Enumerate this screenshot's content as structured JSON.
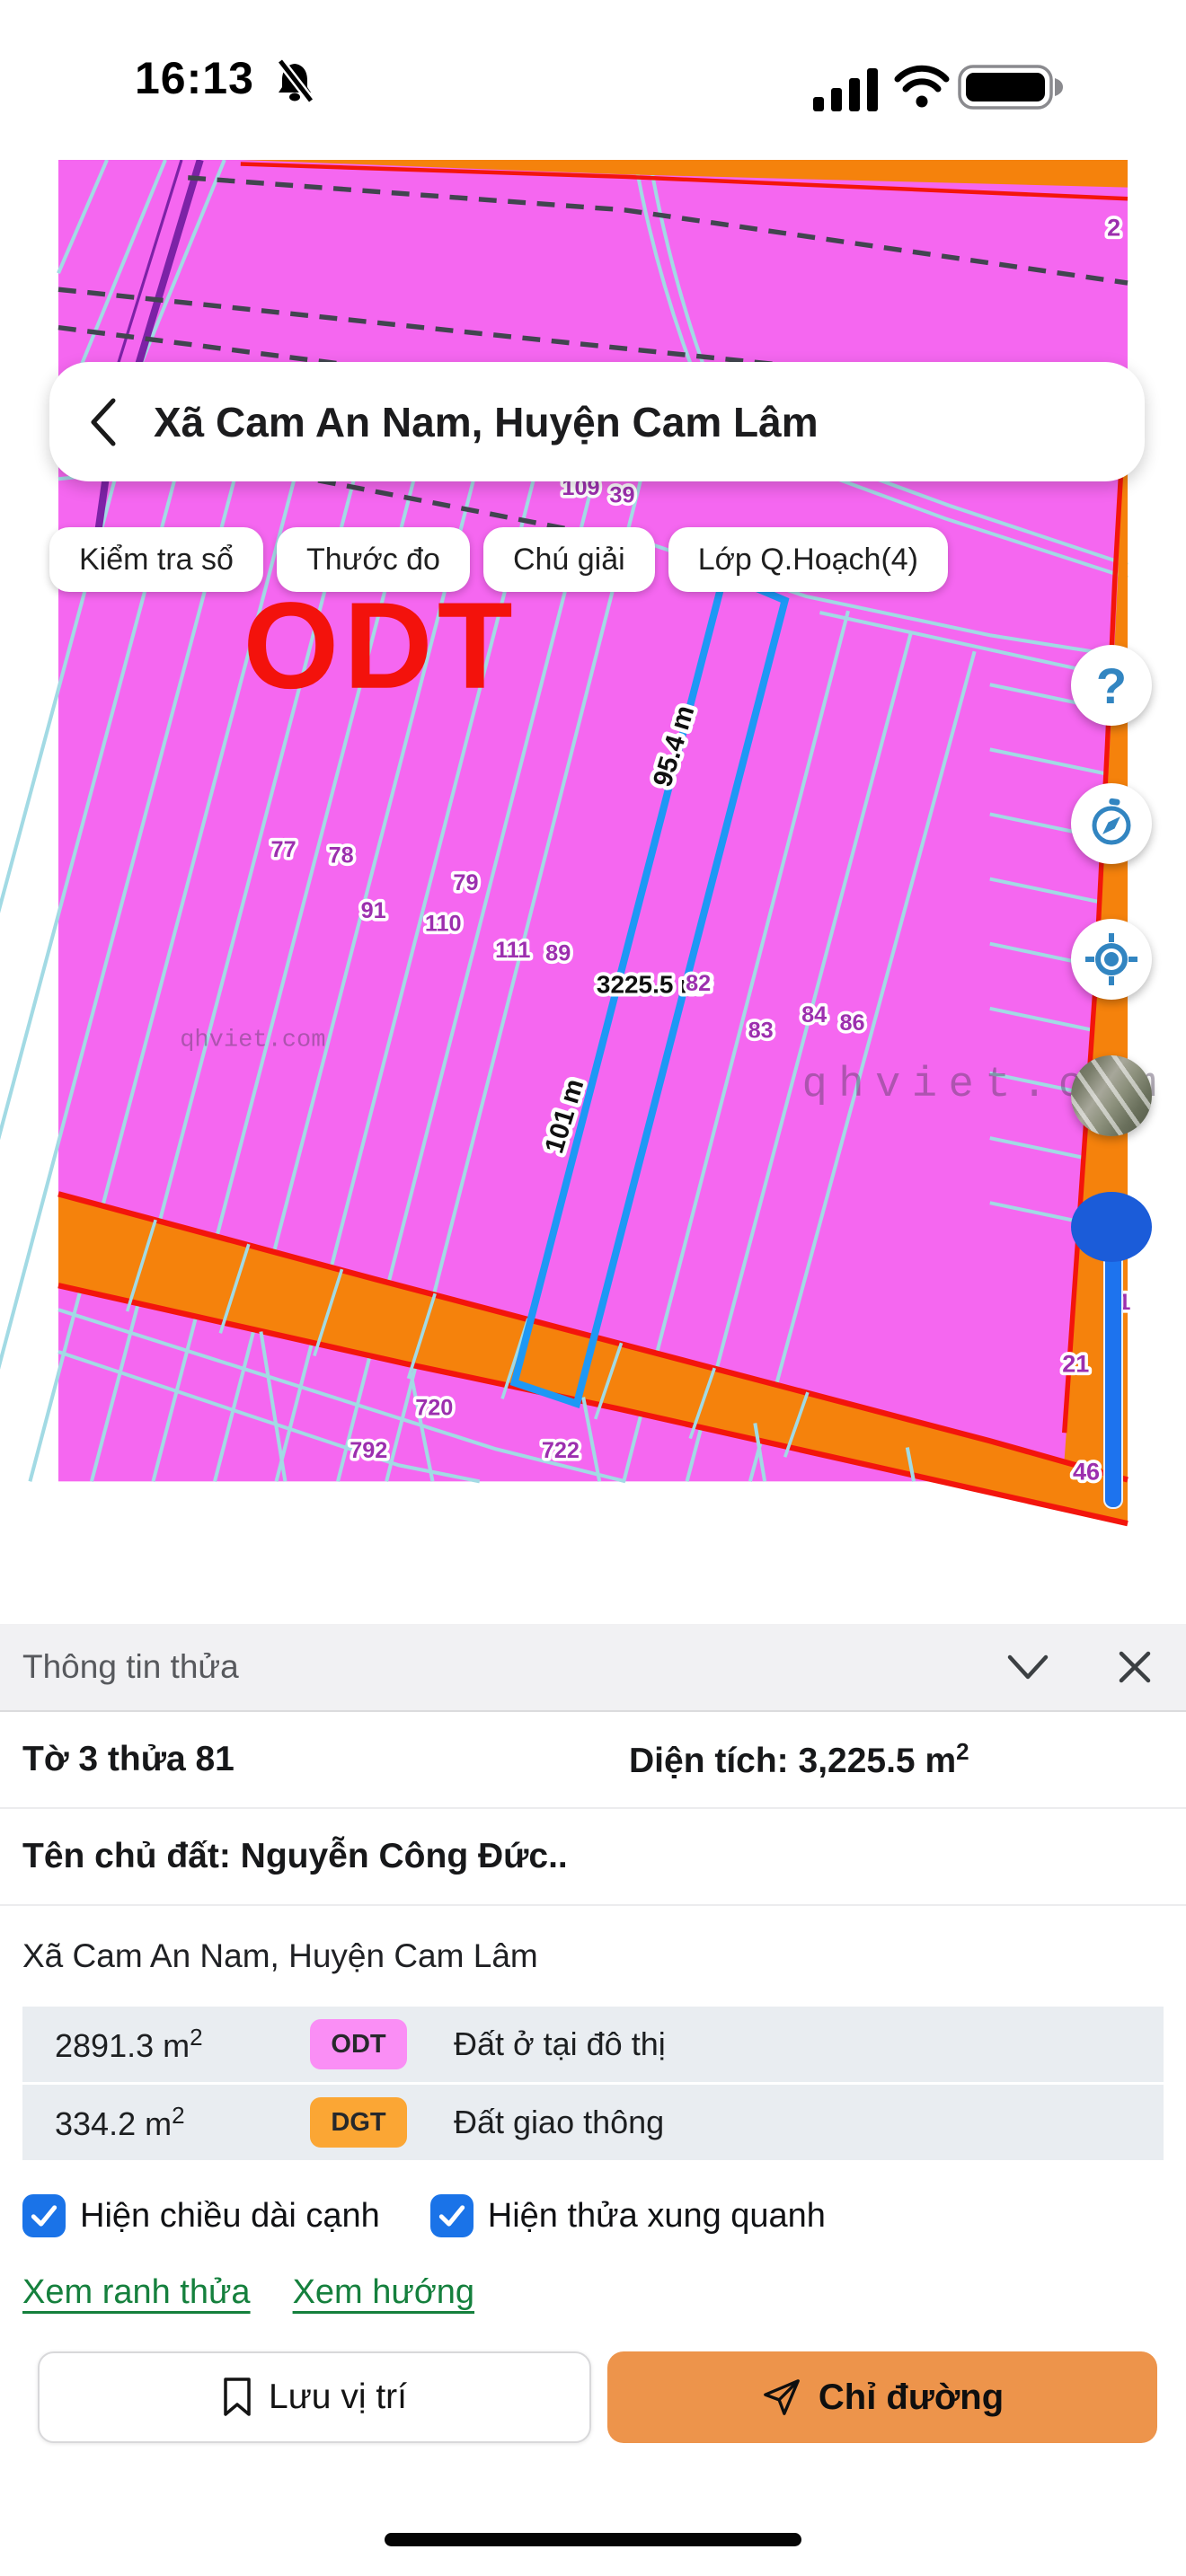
{
  "status_bar": {
    "time": "16:13"
  },
  "search": {
    "query": "Xã Cam An Nam, Huyện Cam Lâm"
  },
  "chips": {
    "items": [
      {
        "label": "Kiểm tra sổ"
      },
      {
        "label": "Thước đo"
      },
      {
        "label": "Chú giải"
      },
      {
        "label": "Lớp Q.Hoạch(4)"
      }
    ]
  },
  "map": {
    "zone_label": "ODT",
    "area_label": "3225.5 m²",
    "watermark": "qhviet.com",
    "dims": {
      "left_edge": "95.4 m",
      "lower_edge": "101 m"
    },
    "parcels": {
      "p109": "109",
      "p39": "39",
      "p2": "2",
      "p77": "77",
      "p78": "78",
      "p79": "79",
      "p91": "91",
      "p110": "110",
      "p111": "111",
      "p89": "89",
      "p82": "82",
      "p84": "84",
      "p86": "86",
      "p83": "83",
      "p720": "720",
      "p792": "792",
      "p722": "722",
      "p21": "21",
      "p46": "46",
      "p1": "1"
    },
    "colors": {
      "zone_pink": "#F567F0",
      "cadastral_line": "#A2DAE4",
      "selected_parcel": "#1E98F5",
      "road_orange": "#F5820C",
      "boundary_red": "#F3150C",
      "label_purple": "#9C2FAE"
    }
  },
  "controls": {
    "help_glyph": "?"
  },
  "panel": {
    "title": "Thông tin thửa",
    "parcel_ref": "Tờ 3 thửa 81",
    "area_prefix": "Diện tích: 3,225.5 m",
    "area_sup": "2",
    "owner": "Tên chủ đất: Nguyễn Công Đức..",
    "address": "Xã Cam An Nam, Huyện Cam Lâm",
    "land_uses": [
      {
        "area": "2891.3 m",
        "sup": "2",
        "code": "ODT",
        "desc": "Đất ở tại đô thị",
        "color": "#FA8EF5"
      },
      {
        "area": "334.2 m",
        "sup": "2",
        "code": "DGT",
        "desc": "Đất giao thông",
        "color": "#FBA634"
      }
    ],
    "checkboxes": [
      {
        "label": "Hiện chiều dài cạnh",
        "checked": true
      },
      {
        "label": "Hiện thửa xung quanh",
        "checked": true
      }
    ],
    "links": [
      {
        "label": "Xem ranh thửa"
      },
      {
        "label": "Xem hướng"
      }
    ],
    "buttons": {
      "save": "Lưu vị trí",
      "directions": "Chỉ đường"
    }
  }
}
